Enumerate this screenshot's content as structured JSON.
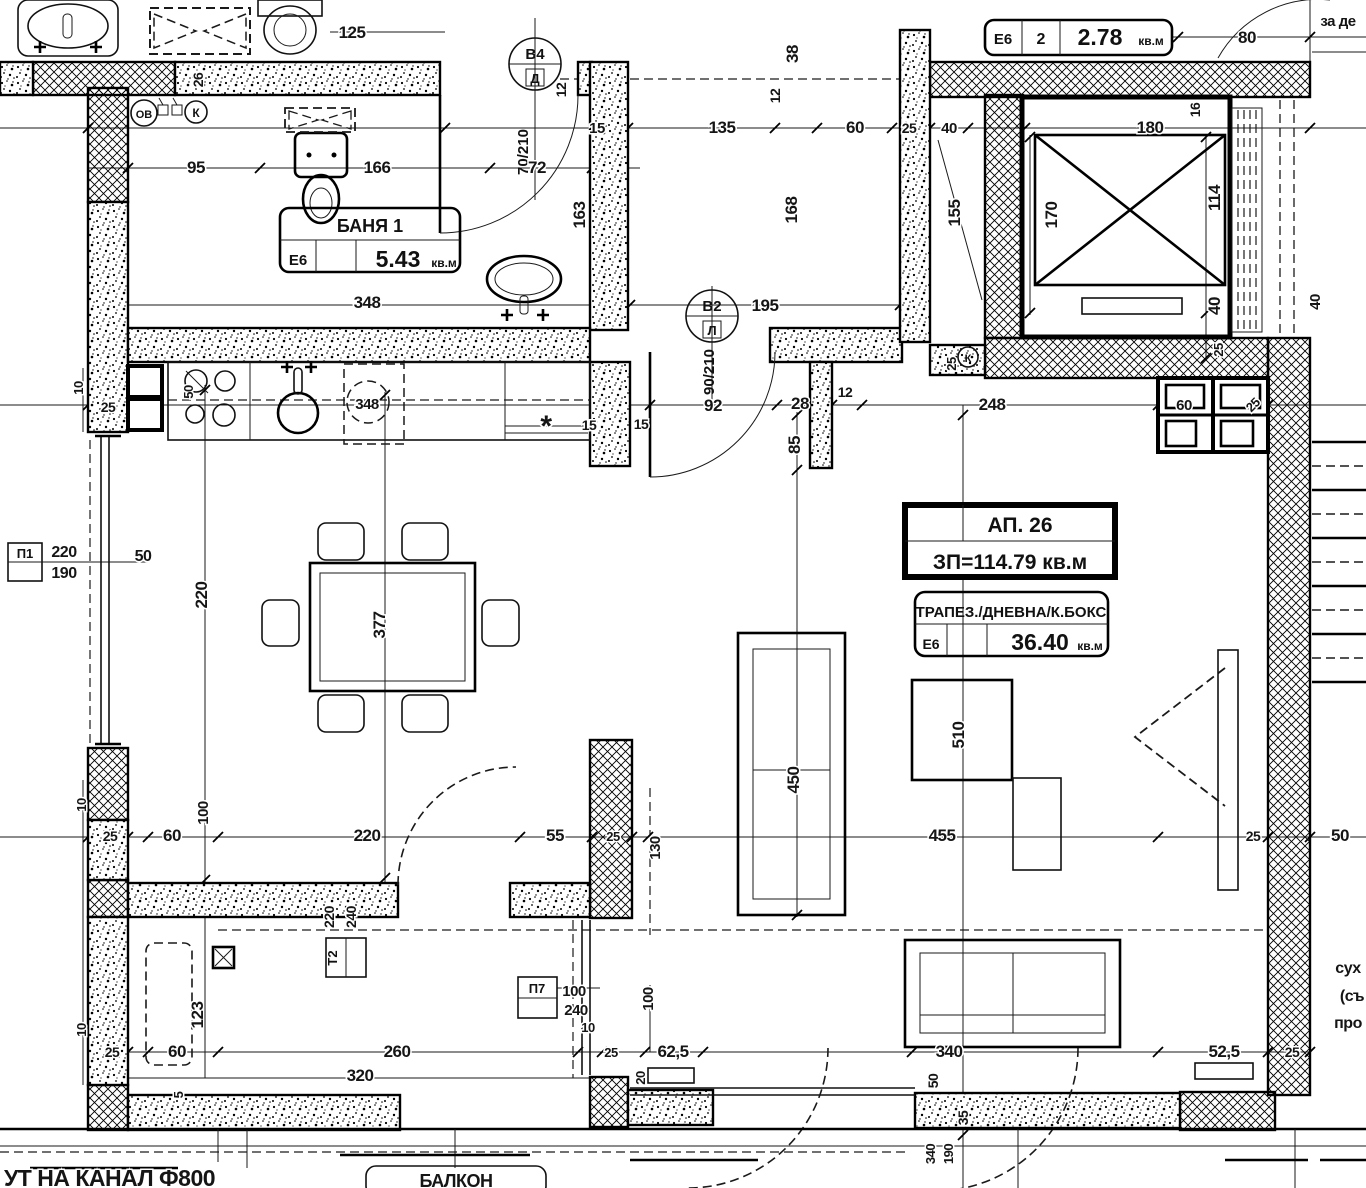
{
  "plan": {
    "tables": {
      "bath": {
        "title": "БАНЯ 1",
        "zone": "Е6",
        "area": "5.43",
        "unit": "кв.м"
      },
      "apt": {
        "line1": "АП. 26",
        "line2": "ЗП=114.79 кв.м"
      },
      "living": {
        "title": "ТРАПЕЗ./ДНЕВНА/К.БОКС",
        "zone": "Е6",
        "area": "36.40",
        "unit": "кв.м"
      },
      "hall": {
        "zone": "Е6",
        "num": "2",
        "area": "2.78",
        "unit": "кв.м"
      }
    },
    "door_markers": [
      {
        "id": "В4",
        "leaf": "Д",
        "size": "70/210"
      },
      {
        "id": "В2",
        "leaf": "Л",
        "size": "90/210"
      }
    ],
    "window_markers": [
      {
        "id": "П1",
        "w": "220",
        "h": "190"
      },
      {
        "id": "П7",
        "w": "100",
        "h": "240"
      }
    ],
    "panel_marker": {
      "id": "Т2",
      "w": "220",
      "h": "240"
    },
    "risers": {
      "heating": "ОВ",
      "sewer1": "К",
      "sewer2": "К"
    },
    "boiler_label": "348"
  },
  "labels": [
    {
      "t": "125",
      "x": 352,
      "y": 38
    },
    {
      "t": "95",
      "x": 196,
      "y": 173
    },
    {
      "t": "166",
      "x": 377,
      "y": 173
    },
    {
      "t": "72",
      "x": 537,
      "y": 173
    },
    {
      "t": "15",
      "x": 597,
      "y": 133,
      "s": 15
    },
    {
      "t": "135",
      "x": 722,
      "y": 133
    },
    {
      "t": "60",
      "x": 855,
      "y": 133
    },
    {
      "t": "25",
      "x": 909,
      "y": 133,
      "s": 14
    },
    {
      "t": "40",
      "x": 949,
      "y": 133,
      "s": 15
    },
    {
      "t": "180",
      "x": 1150,
      "y": 133
    },
    {
      "t": "80",
      "x": 1247,
      "y": 43
    },
    {
      "t": "за де",
      "x": 1338,
      "y": 26,
      "s": 15,
      "n": "note-top-right"
    },
    {
      "t": "26",
      "x": 203,
      "y": 80,
      "r": -90,
      "s": 14
    },
    {
      "t": "12",
      "x": 566,
      "y": 90,
      "r": -90,
      "s": 14
    },
    {
      "t": "38",
      "x": 798,
      "y": 54,
      "r": -90
    },
    {
      "t": "12",
      "x": 780,
      "y": 96,
      "r": -90,
      "s": 14
    },
    {
      "t": "163",
      "x": 585,
      "y": 215,
      "r": -90
    },
    {
      "t": "168",
      "x": 797,
      "y": 210,
      "r": -90
    },
    {
      "t": "155",
      "x": 960,
      "y": 213,
      "r": -90
    },
    {
      "t": "170",
      "x": 1057,
      "y": 215,
      "r": -90
    },
    {
      "t": "16",
      "x": 1200,
      "y": 110,
      "r": -90,
      "s": 14
    },
    {
      "t": "114",
      "x": 1220,
      "y": 198,
      "r": -90
    },
    {
      "t": "40",
      "x": 1220,
      "y": 306,
      "r": -90
    },
    {
      "t": "25",
      "x": 1223,
      "y": 350,
      "r": -90,
      "s": 13
    },
    {
      "t": "40",
      "x": 1320,
      "y": 302,
      "r": -90,
      "s": 15
    },
    {
      "t": "348",
      "x": 367,
      "y": 308
    },
    {
      "t": "195",
      "x": 765,
      "y": 311
    },
    {
      "t": "92",
      "x": 713,
      "y": 411
    },
    {
      "t": "28",
      "x": 800,
      "y": 409
    },
    {
      "t": "12",
      "x": 845,
      "y": 397,
      "s": 14
    },
    {
      "t": "85",
      "x": 800,
      "y": 445,
      "r": -90
    },
    {
      "t": "15",
      "x": 589,
      "y": 430,
      "s": 14
    },
    {
      "t": "15",
      "x": 641,
      "y": 429,
      "s": 14
    },
    {
      "t": "*",
      "x": 546,
      "y": 436,
      "s": 30
    },
    {
      "t": "348",
      "x": 367,
      "y": 409,
      "s": 15,
      "n": "boiler-label"
    },
    {
      "t": "25",
      "x": 108,
      "y": 412,
      "s": 14
    },
    {
      "t": "10",
      "x": 83,
      "y": 388,
      "r": -90,
      "s": 13
    },
    {
      "t": "50",
      "x": 193,
      "y": 392,
      "r": -90,
      "s": 13
    },
    {
      "t": "25",
      "x": 956,
      "y": 364,
      "r": -90,
      "s": 13
    },
    {
      "t": "248",
      "x": 992,
      "y": 410
    },
    {
      "t": "60",
      "x": 1184,
      "y": 410,
      "s": 15
    },
    {
      "t": "25",
      "x": 1256,
      "y": 408,
      "r": -45,
      "s": 13
    },
    {
      "t": "220",
      "x": 64,
      "y": 557,
      "s": 16,
      "n": "window-width-label"
    },
    {
      "t": "190",
      "x": 64,
      "y": 578,
      "s": 16,
      "n": "window-height-label"
    },
    {
      "t": "50",
      "x": 143,
      "y": 561,
      "s": 16
    },
    {
      "t": "220",
      "x": 207,
      "y": 595,
      "r": -90
    },
    {
      "t": "377",
      "x": 385,
      "y": 625,
      "r": -90
    },
    {
      "t": "510",
      "x": 964,
      "y": 735,
      "r": -90
    },
    {
      "t": "450",
      "x": 799,
      "y": 780,
      "r": -90
    },
    {
      "t": "10",
      "x": 86,
      "y": 805,
      "r": -90,
      "s": 13
    },
    {
      "t": "25",
      "x": 110,
      "y": 841,
      "s": 14
    },
    {
      "t": "60",
      "x": 172,
      "y": 841
    },
    {
      "t": "100",
      "x": 208,
      "y": 813,
      "r": -90,
      "s": 15
    },
    {
      "t": "220",
      "x": 367,
      "y": 841
    },
    {
      "t": "55",
      "x": 555,
      "y": 841
    },
    {
      "t": "25",
      "x": 613,
      "y": 841,
      "s": 13
    },
    {
      "t": "130",
      "x": 660,
      "y": 848,
      "r": -90,
      "s": 15
    },
    {
      "t": "455",
      "x": 942,
      "y": 841
    },
    {
      "t": "25",
      "x": 1253,
      "y": 841,
      "s": 14
    },
    {
      "t": "50",
      "x": 1340,
      "y": 841
    },
    {
      "t": "220",
      "x": 334,
      "y": 917,
      "r": -90,
      "s": 14
    },
    {
      "t": "240",
      "x": 356,
      "y": 917,
      "r": -90,
      "s": 14
    },
    {
      "t": "123",
      "x": 203,
      "y": 1015,
      "r": -90
    },
    {
      "t": "10",
      "x": 86,
      "y": 1030,
      "r": -90,
      "s": 13
    },
    {
      "t": "25",
      "x": 112,
      "y": 1057,
      "s": 14
    },
    {
      "t": "60",
      "x": 177,
      "y": 1057
    },
    {
      "t": "5",
      "x": 183,
      "y": 1095,
      "r": -90,
      "s": 13
    },
    {
      "t": "260",
      "x": 397,
      "y": 1057
    },
    {
      "t": "320",
      "x": 360,
      "y": 1081
    },
    {
      "t": "100",
      "x": 574,
      "y": 996,
      "s": 15
    },
    {
      "t": "240",
      "x": 576,
      "y": 1015,
      "s": 15
    },
    {
      "t": "10",
      "x": 588,
      "y": 1032,
      "s": 13
    },
    {
      "t": "25",
      "x": 611,
      "y": 1057,
      "s": 13
    },
    {
      "t": "62,5",
      "x": 673,
      "y": 1057
    },
    {
      "t": "100",
      "x": 653,
      "y": 999,
      "r": -90,
      "s": 15
    },
    {
      "t": "20",
      "x": 645,
      "y": 1078,
      "r": -90,
      "s": 13
    },
    {
      "t": "340",
      "x": 949,
      "y": 1057
    },
    {
      "t": "50",
      "x": 938,
      "y": 1081,
      "r": -90,
      "s": 14
    },
    {
      "t": "35",
      "x": 968,
      "y": 1118,
      "r": -90,
      "s": 14
    },
    {
      "t": "340",
      "x": 935,
      "y": 1154,
      "r": -90,
      "s": 13
    },
    {
      "t": "190",
      "x": 953,
      "y": 1154,
      "r": -90,
      "s": 13
    },
    {
      "t": "52,5",
      "x": 1224,
      "y": 1057
    },
    {
      "t": "25",
      "x": 1292,
      "y": 1057,
      "s": 14
    },
    {
      "t": "сух",
      "x": 1348,
      "y": 973,
      "s": 16,
      "n": "note-right"
    },
    {
      "t": "(съ",
      "x": 1352,
      "y": 1001,
      "s": 16,
      "n": "note-right"
    },
    {
      "t": "про",
      "x": 1348,
      "y": 1028,
      "s": 16,
      "n": "note-right"
    },
    {
      "t": "УТ НА КАНАЛ Ф800",
      "x": 4,
      "y": 1186,
      "s": 23,
      "a": "start",
      "n": "note-canal"
    },
    {
      "t": "БАЛКОН",
      "x": 456,
      "y": 1187,
      "s": 18,
      "n": "room-label-balcony"
    }
  ]
}
